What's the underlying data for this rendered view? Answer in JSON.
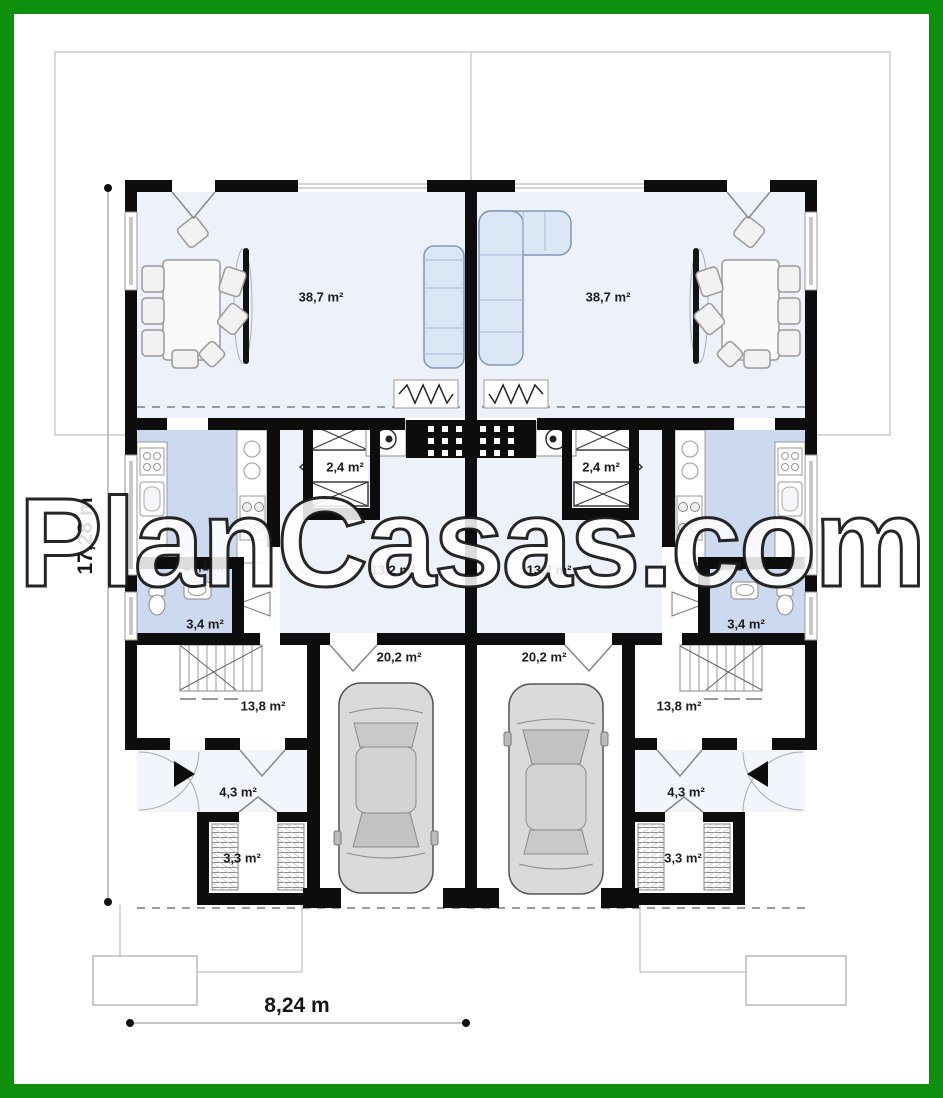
{
  "watermark": {
    "text": "PlanCasas.com"
  },
  "dimensions": {
    "height": "17,28 m",
    "width": "8,24 m"
  },
  "rooms": {
    "left_unit": {
      "living_room": "38,7 m²",
      "closet": "2,4 m²",
      "kitchen": "10,1 m²",
      "hall": "13,2 m²",
      "bathroom": "3,4 m²",
      "garage": "20,2 m²",
      "room": "13,8 m²",
      "entry": "4,3 m²",
      "wardrobe": "3,3 m²"
    },
    "right_unit": {
      "living_room": "38,7 m²",
      "closet": "2,4 m²",
      "kitchen": "10,1 m²",
      "hall": "13,2 m²",
      "bathroom": "3,4 m²",
      "garage": "20,2 m²",
      "room": "13,8 m²",
      "entry": "4,3 m²",
      "wardrobe": "3,3 m²"
    }
  },
  "colors": {
    "frame_green": "#0e8f0e",
    "wall_black": "#0d0d0d",
    "floor_light": "#ecf1fa",
    "floor_blue": "#ccd9ee",
    "furniture_blue": "#dce7f6",
    "outline_gray": "#b5b5b5"
  }
}
